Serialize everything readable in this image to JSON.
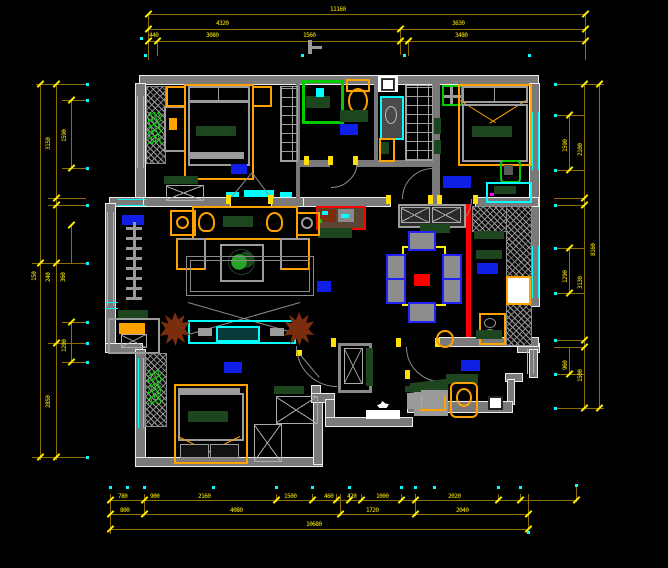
{
  "canvas": {
    "width": 668,
    "height": 568,
    "background": "#000000"
  },
  "palette": {
    "wall": "#7a7a7a",
    "wall_outline": "#ededed",
    "dim_line": "#8f6f00",
    "dim_text": "#ffee00",
    "window": "#00ffff",
    "furniture_accent": "#ffa200",
    "soft_green": "#1e461e",
    "label_blue": "#0f1fe6",
    "highlight_red": "#ff0000",
    "fixture_green": "#00cc00",
    "chair_blue": "#2222ff",
    "plant_brown": "#7a2e0e"
  },
  "dims": {
    "t1a": "11160",
    "t2a": "4320",
    "t2b": "3630",
    "t3d": "440",
    "t3a": "3080",
    "t3b": "1560",
    "t3c": "3480",
    "b1a": "780",
    "b1b": "900",
    "b1c": "2160",
    "b1d": "1500",
    "b1e": "460",
    "b1f": "420",
    "b1g": "1000",
    "b1h": "2020",
    "b2a": "800",
    "b2b": "4080",
    "b2c": "1720",
    "b2d": "2040",
    "b3a": "10680",
    "lA": "3150",
    "lB": "1590",
    "l1": "150",
    "l2": "240",
    "l3": "360",
    "lC": "2850",
    "lD": "1200",
    "r1": "1590",
    "r2": "2100",
    "r3": "8160",
    "r4": "1290",
    "r5": "3130",
    "r6": "960",
    "r7": "1500"
  }
}
